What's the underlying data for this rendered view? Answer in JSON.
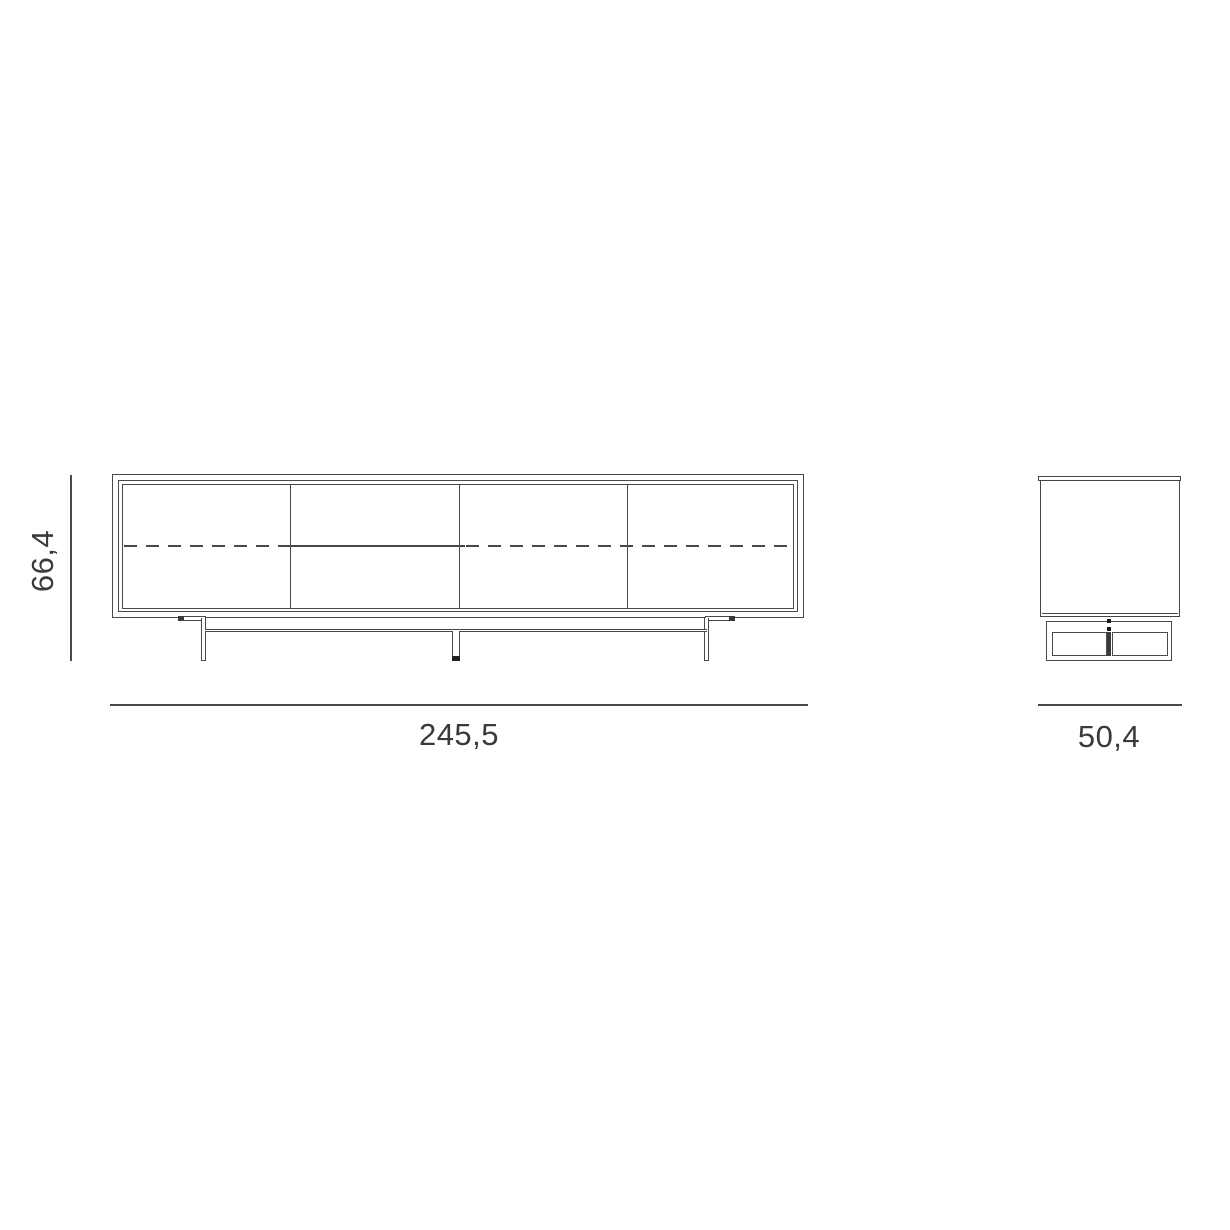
{
  "page": {
    "background": "#ffffff",
    "content": "furniture technical drawing, sideboard front and side elevation"
  },
  "colors": {
    "line": "#4a4a4a",
    "dark_fill": "#222222",
    "text": "#3a3a3a"
  },
  "front_view": {
    "door_panels": 4,
    "dividers": 3,
    "legs": 3,
    "shelf_line_style": "dashed",
    "drawer_divider_line_style": "solid"
  },
  "side_view": {
    "base_panels": 2,
    "dots": 2
  },
  "dimensions": {
    "height": "66,4",
    "width": "245,5",
    "depth": "50,4"
  }
}
